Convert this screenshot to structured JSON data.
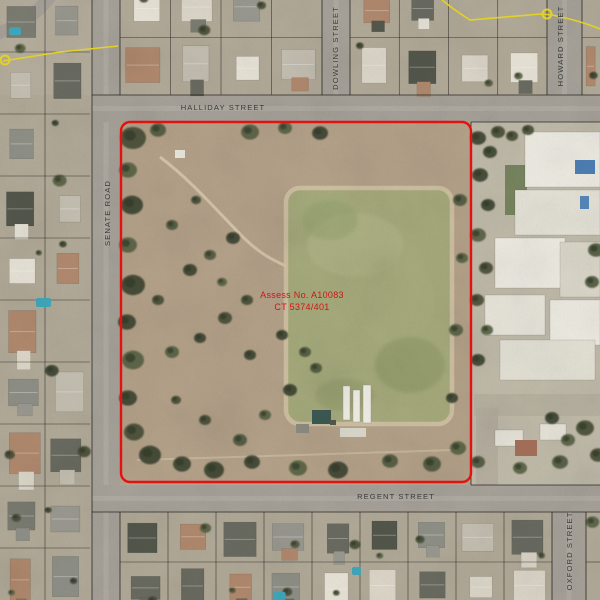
{
  "parcel": {
    "assess_label": "Assess No. A10083",
    "ct_label": "CT 5374/401"
  },
  "streets": {
    "halliday": "HALLIDAY STREET",
    "senate": "SENATE ROAD",
    "dowling": "DOWLING STREET",
    "howard": "HOWARD STREET",
    "regent": "REGENT STREET",
    "oxford": "OXFORD STREET"
  },
  "colors": {
    "boundary_red": "#e41111",
    "label_red": "#cf1414",
    "street_text": "#3a3a3a",
    "utility_yellow": "#e3d224",
    "road_gray": "#a7a39a",
    "parcel_dirt": "#b5a28a",
    "paddock_green": "#a6ab7c",
    "cadastre_black": "#151515"
  }
}
